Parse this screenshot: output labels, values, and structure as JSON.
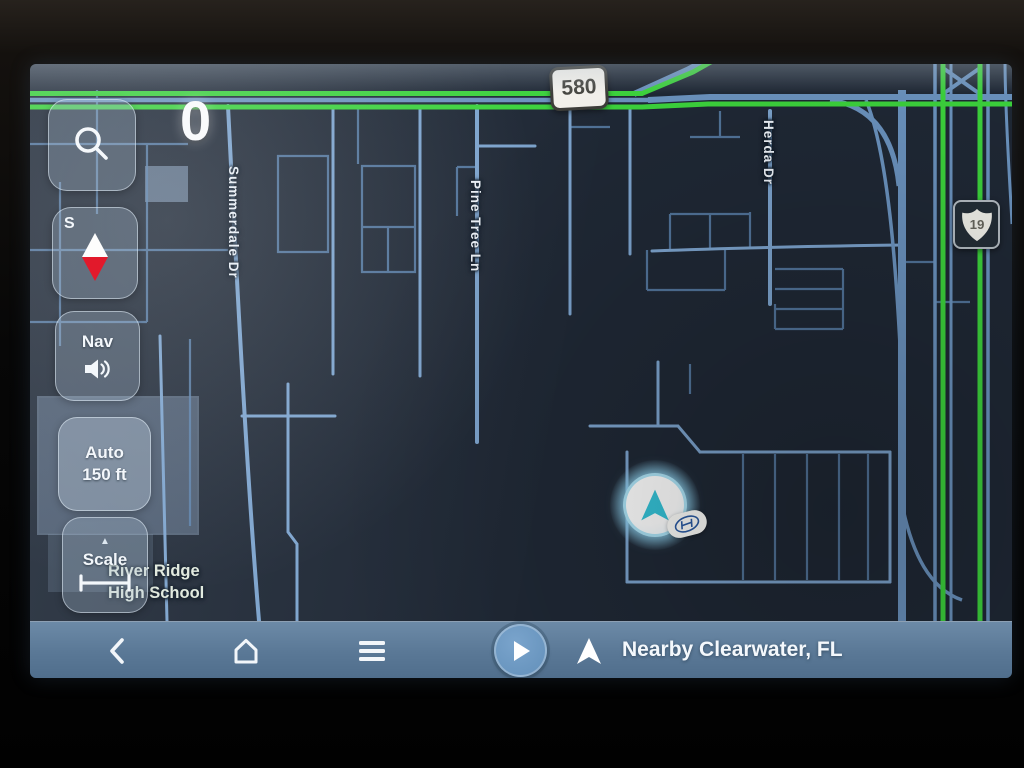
{
  "map": {
    "zoom_counter": "0",
    "street_labels": {
      "summerdale": "Summerdale Dr",
      "pine_tree": "Pine Tree Ln",
      "herda": "Herda Dr"
    },
    "poi": {
      "line1": "River Ridge",
      "line2": "High School"
    },
    "shields": {
      "route_580": "580",
      "us_19": "19"
    },
    "colors": {
      "route_green": "#3cd33c",
      "road_blue": "#7ca3cd",
      "map_background": "#1f2835",
      "marker_cyan": "#35c3d8"
    }
  },
  "controls": {
    "compass": {
      "cardinal": "S"
    },
    "nav_volume": {
      "label": "Nav"
    },
    "auto_scale": {
      "line1": "Auto",
      "line2": "150 ft"
    },
    "scale": {
      "label": "Scale",
      "expander": "▲"
    }
  },
  "bottom_bar": {
    "destination": "Nearby Clearwater, FL",
    "bar_color": "#5e7e9d"
  }
}
